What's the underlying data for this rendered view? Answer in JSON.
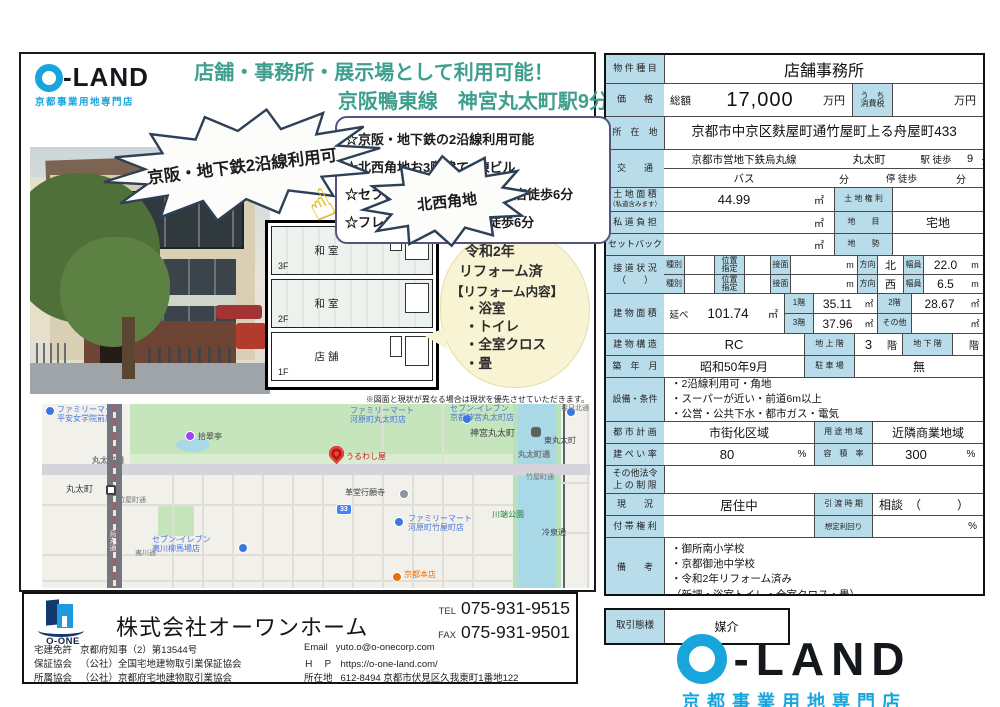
{
  "brand": {
    "name_rest": "-LAND",
    "sub": "京都事業用地専門店",
    "accent": "#18a5dd"
  },
  "left": {
    "headline1": "店舗・事務所・展示場として利用可能！",
    "headline2": "京阪鴨東線　神宮丸太町駅9分",
    "burst1": "京阪・地下鉄2沿線利用可",
    "burst2": "北西角地",
    "features": [
      "☆京阪・地下鉄の2沿線利用可能",
      "☆北西角地お3階建て1棟ビル",
      "☆セブンイレブン夷川柳馬場店徒歩6分",
      "☆フレスコ河原町丸太町徒歩6分"
    ],
    "floors": [
      {
        "f": "3F",
        "room": "和室"
      },
      {
        "f": "2F",
        "room": "和室"
      },
      {
        "f": "1F",
        "room": "店舗"
      }
    ],
    "bubble": {
      "l1": "令和2年",
      "l2": "リフォーム済",
      "l3": "【リフォーム内容】",
      "items": [
        "・浴室",
        "・トイレ",
        "・全室クロス",
        "・畳"
      ]
    },
    "disclaimer": "※図面と現状が異なる場合は現状を優先させていただきます。"
  },
  "map": {
    "labels": [
      "ファミリーマート\n平安女学院前店",
      "拾翠亭",
      "丸太町通",
      "丸太町",
      "竹屋町通",
      "夷川通",
      "セブン-イレブン\n夷川柳馬場店",
      "ファミリーマート\n河原町丸太町店",
      "セブン-イレブン\n京都神宮丸太町店",
      "神宮丸太町",
      "東丸太町",
      "丸太町通",
      "春日北通",
      "うるわし屋",
      "革堂行願寺",
      "竹屋町通",
      "ファミリーマート\n河原町竹屋町店",
      "川端公園",
      "冷泉通",
      "烏丸通",
      "京都本店",
      "33"
    ]
  },
  "table": {
    "type": {
      "label": "物 件 種 目",
      "value": "店舗事務所"
    },
    "price": {
      "label": "価　　格",
      "prefix": "総額",
      "value": "17,000",
      "unit": "万円",
      "tax_label": "う　ち\n消費税",
      "unit2": "万円"
    },
    "address": {
      "label": "所　在　地",
      "value": "京都市中京区麩屋町通竹屋町上る舟屋町433"
    },
    "access": {
      "label": "交　　通",
      "line": "京都市営地下鉄烏丸線",
      "station": "丸太町",
      "walk": "駅 徒歩",
      "min": "9",
      "unit": "分",
      "bus": "バス",
      "bus_unit": "分",
      "stop": "停 徒歩",
      "stop_unit": "分"
    },
    "land": {
      "label": "土 地 面 積",
      "sublabel": "（私道含みます）",
      "value": "44.99",
      "unit": "㎡",
      "right_label": "土 地 権 利",
      "right_value": ""
    },
    "road_burden": {
      "label": "私 道 負 担",
      "unit": "㎡",
      "right_label": "地　　目",
      "right_value": "宅地"
    },
    "setback": {
      "label": "セットバック",
      "unit": "㎡",
      "right_label": "地　　勢",
      "right_value": ""
    },
    "frontage": {
      "label": "接 道 状 況\n（　　）",
      "r1": {
        "k1": "種別",
        "k2": "位置\n指定",
        "k3": "接面",
        "m": "m",
        "dir_label": "方向",
        "dir": "北",
        "w_label": "幅員",
        "w": "22.0",
        "wu": "m"
      },
      "r2": {
        "k1": "種別",
        "k2": "位置\n指定",
        "k3": "接面",
        "m": "m",
        "dir_label": "方向",
        "dir": "西",
        "w_label": "幅員",
        "w": "6.5",
        "wu": "m"
      }
    },
    "building_area": {
      "label": "建 物 面 積",
      "prefix": "延べ",
      "value": "101.74",
      "unit": "㎡",
      "f1_label": "1階",
      "f1": "35.11",
      "f2_label": "2階",
      "f2": "28.67",
      "f3_label": "3階",
      "f3": "37.96",
      "other_label": "その他",
      "u": "㎡"
    },
    "structure": {
      "label": "建 物 構 造",
      "value": "RC",
      "above_label": "地 上 階",
      "above": "3",
      "unit": "階",
      "below_label": "地 下 階",
      "below": "",
      "unit2": "階"
    },
    "built": {
      "label": "築　年　月",
      "value": "昭和50年9月",
      "parking_label": "駐 車 場",
      "parking": "無"
    },
    "equipment": {
      "label": "設備・条件",
      "lines": "・2沿線利用可・角地\n・スーパーが近い・前道6m以上\n・公営・公共下水・都市ガス・電気"
    },
    "city_plan": {
      "label": "都 市 計 画",
      "value": "市街化区域",
      "zone_label": "用 途 地 域",
      "zone": "近隣商業地域"
    },
    "coverage": {
      "label": "建 ぺ い 率",
      "value": "80",
      "unit": "%",
      "far_label": "容　積　率",
      "far": "300",
      "far_unit": "%"
    },
    "other_law": {
      "label": "その他法令\n上 の 制 限",
      "value": ""
    },
    "status": {
      "label": "現　　況",
      "value": "居住中",
      "handover_label": "引 渡 時 期",
      "handover": "相談　（　　　）"
    },
    "rights": {
      "label": "付 帯 権 利",
      "value": "",
      "yield_label": "想定利回り",
      "yield_unit": "%"
    },
    "notes": {
      "label": "備　　考",
      "lines": "・御所南小学校\n・京都御池中学校\n・令和2年リフォーム済み\n（新調・浴室トイレ・全室クロス・畳）"
    },
    "deal": {
      "label": "取引態様",
      "value": "媒介"
    }
  },
  "footer": {
    "company": "株式会社オーワンホーム",
    "logo_text": "O-ONE",
    "tel_label": "TEL",
    "tel": "075-931-9515",
    "fax_label": "FAX",
    "fax": "075-931-9501",
    "license_label": "宅建免許",
    "license": "京都府知事（2）第13544号",
    "guarantee_label": "保証協会",
    "guarantee": "（公社）全国宅地建物取引業保証協会",
    "assoc_label": "所属協会",
    "assoc": "（公社）京都府宅地建物取引業協会",
    "email_label": "Email",
    "email": "yuto.o@o-onecorp.com",
    "hp_label": "Ｈ　Ｐ",
    "hp": "https://o-one-land.com/",
    "addr_label": "所在地",
    "addr": "612-8494 京都市伏見区久我東町1番地122"
  }
}
